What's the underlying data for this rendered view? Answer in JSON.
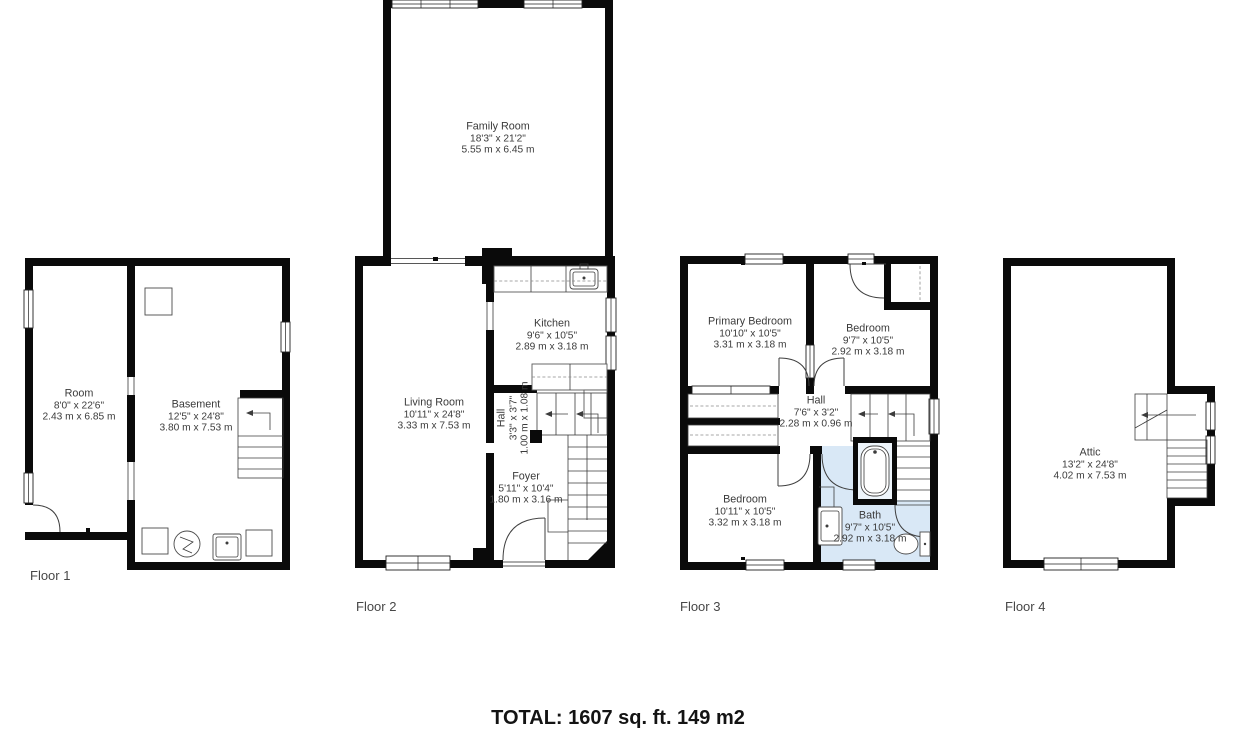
{
  "total_label": "TOTAL: 1607 sq. ft. 149 m2",
  "colors": {
    "wall": "#0a0a0a",
    "bath_fill": "#d9e8f6",
    "room_text": "#3b3b3b",
    "floor_label_text": "#474747"
  },
  "floors": [
    {
      "label": "Floor 1",
      "rooms": [
        {
          "name": "Room",
          "imperial": "8'0\" x 22'6\"",
          "metric": "2.43 m x 6.85 m"
        },
        {
          "name": "Basement",
          "imperial": "12'5\" x 24'8\"",
          "metric": "3.80 m x 7.53 m"
        }
      ]
    },
    {
      "label": "Floor 2",
      "rooms": [
        {
          "name": "Family Room",
          "imperial": "18'3\" x 21'2\"",
          "metric": "5.55 m x 6.45 m"
        },
        {
          "name": "Kitchen",
          "imperial": "9'6\" x 10'5\"",
          "metric": "2.89 m x 3.18 m"
        },
        {
          "name": "Living Room",
          "imperial": "10'11\" x 24'8\"",
          "metric": "3.33 m x 7.53 m"
        },
        {
          "name": "Hall",
          "imperial": "3'3\" x 3'7\"",
          "metric": "1.00 m x 1.08 m"
        },
        {
          "name": "Foyer",
          "imperial": "5'11\" x 10'4\"",
          "metric": "1.80 m x 3.16 m"
        }
      ]
    },
    {
      "label": "Floor 3",
      "rooms": [
        {
          "name": "Primary Bedroom",
          "imperial": "10'10\" x 10'5\"",
          "metric": "3.31 m x 3.18 m"
        },
        {
          "name": "Bedroom",
          "imperial": "9'7\" x 10'5\"",
          "metric": "2.92 m x 3.18 m"
        },
        {
          "name": "Hall",
          "imperial": "7'6\" x 3'2\"",
          "metric": "2.28 m x 0.96 m"
        },
        {
          "name": "Bedroom",
          "imperial": "10'11\" x 10'5\"",
          "metric": "3.32 m x 3.18 m"
        },
        {
          "name": "Bath",
          "imperial": "9'7\" x 10'5\"",
          "metric": "2.92 m x 3.18 m"
        }
      ]
    },
    {
      "label": "Floor 4",
      "rooms": [
        {
          "name": "Attic",
          "imperial": "13'2\" x 24'8\"",
          "metric": "4.02 m x 7.53 m"
        }
      ]
    }
  ]
}
